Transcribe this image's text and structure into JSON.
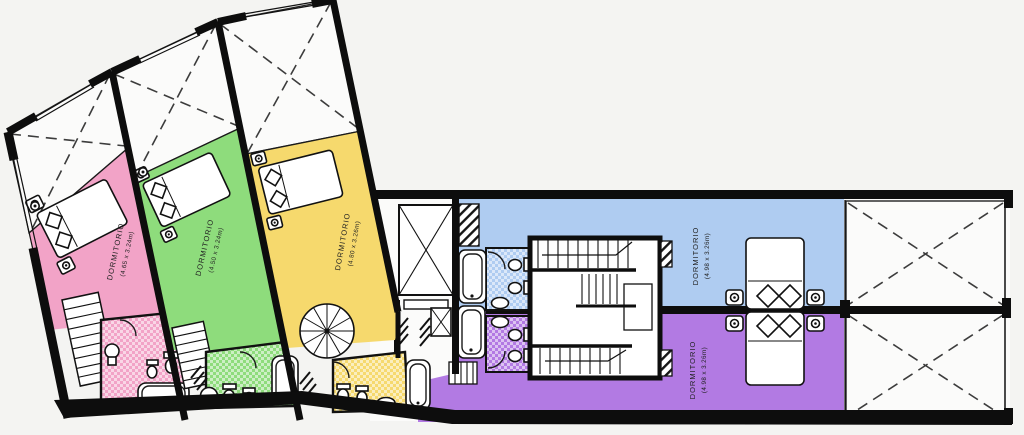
{
  "plan": {
    "background": "#f4f4f2",
    "wall_color": "#0d0d0d",
    "floor_white": "#fbfbfa",
    "rooms": [
      {
        "name": "bedroom-pink",
        "label": "DORMITORIO",
        "dims": "(4.65 x 3.24m)",
        "color": "#f2a3c7"
      },
      {
        "name": "bedroom-green",
        "label": "DORMITORIO",
        "dims": "(4.50 x 3.24m)",
        "color": "#8edc7c"
      },
      {
        "name": "bedroom-yellow",
        "label": "DORMITORIO",
        "dims": "(4.80 x 3.26m)",
        "color": "#f6d96d"
      },
      {
        "name": "bedroom-blue",
        "label": "DORMITORIO",
        "dims": "(4.98 x 3.26m)",
        "color": "#afccf1"
      },
      {
        "name": "bedroom-purple",
        "label": "DORMITORIO",
        "dims": "(4.98 x 3.26m)",
        "color": "#b27ae3"
      }
    ]
  }
}
